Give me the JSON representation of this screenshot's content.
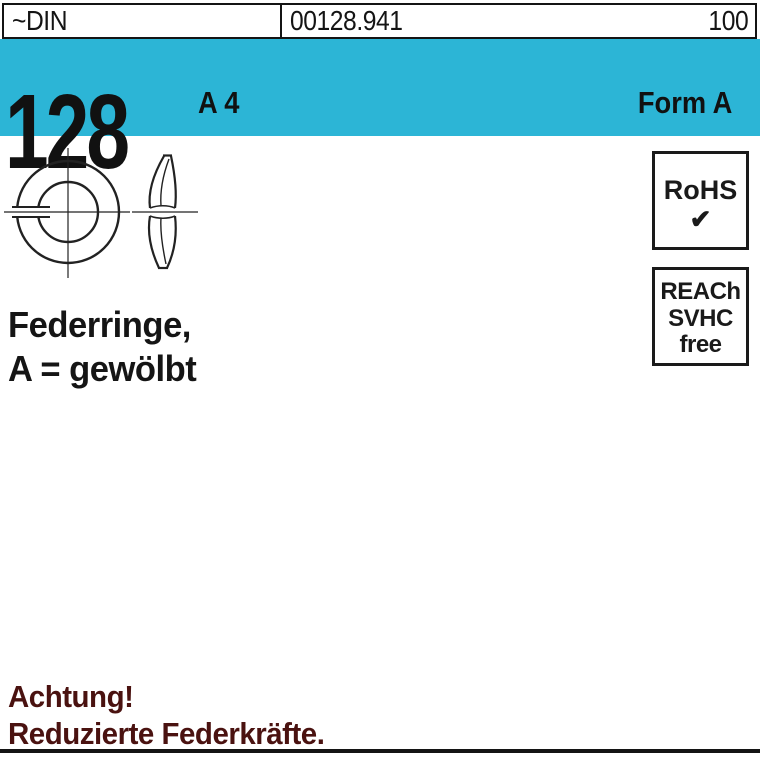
{
  "header": {
    "standard": "~DIN",
    "article_number": "00128.941",
    "packaging_quantity": "100"
  },
  "band": {
    "din_number": "128",
    "material": "A 4",
    "form": "Form A",
    "background_color": "#2cb5d6"
  },
  "badges": {
    "rohs": {
      "label": "RoHS",
      "check": "✔"
    },
    "reach": {
      "lines": [
        "REACh",
        "SVHC",
        "free"
      ]
    }
  },
  "product": {
    "title_line1": "Federringe,",
    "title_line2": "A = gewölbt"
  },
  "warning": {
    "line1": "Achtung!",
    "line2": "Reduzierte Federkräfte.",
    "color": "#4a1210"
  }
}
